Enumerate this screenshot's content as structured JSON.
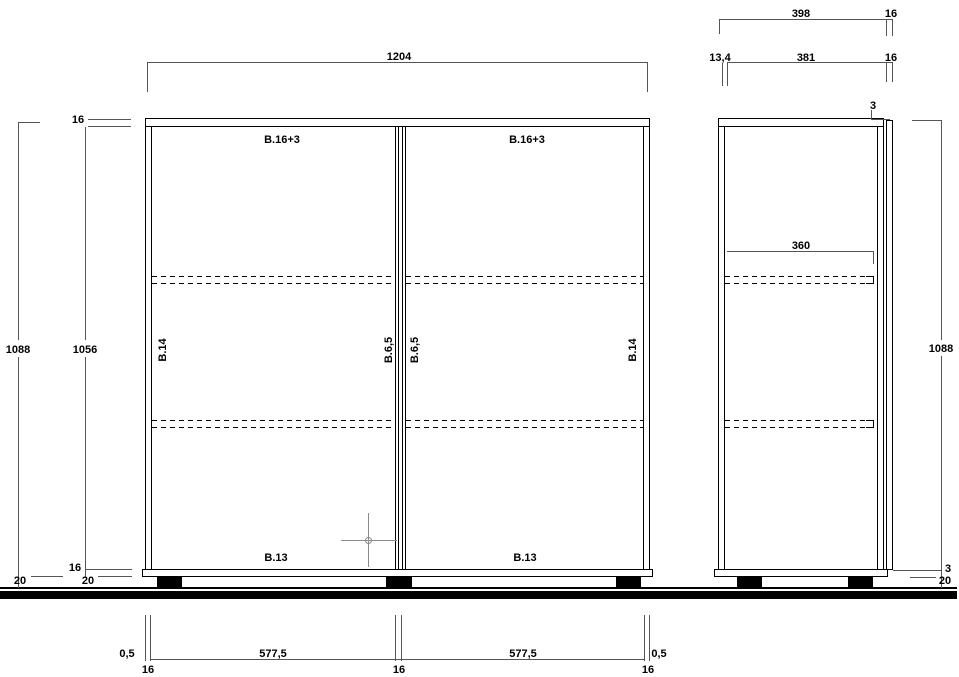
{
  "canvas": {
    "background": "#ffffff"
  },
  "colors": {
    "drawing_line": "#000000",
    "dimension_line": "#555555",
    "crosshair": "#8c8c8c",
    "foot_fill": "#000000",
    "ground_fill": "#000000"
  },
  "front_view": {
    "dim_width": "1204",
    "dim_top_thickness": "16",
    "dim_height_outer": "1088",
    "dim_height_inner": "1056",
    "dim_bottom_thickness": "16",
    "dim_plinth_left": "20",
    "dim_plinth_right": "20",
    "label_top_panel_left": "B.16+3",
    "label_top_panel_right": "B.16+3",
    "label_side_panel_left": "B.14",
    "label_side_panel_right": "B.14",
    "label_divider_left": "B.6,5",
    "label_divider_right": "B.6,5",
    "label_bottom_panel_left": "B.13",
    "label_bottom_panel_right": "B.13",
    "bottom_dims": {
      "offset_left": "0,5",
      "thickness_left": "16",
      "bay_left": "577,5",
      "thickness_center": "16",
      "bay_right": "577,5",
      "thickness_right": "16",
      "offset_right": "0,5"
    }
  },
  "side_view": {
    "dim_depth_outer": "398",
    "dim_front_top": "16",
    "dim_back_inset": "13,4",
    "dim_depth_inner": "381",
    "dim_front": "16",
    "dim_gap_top": "3",
    "dim_shelf_depth": "360",
    "dim_height": "1088",
    "dim_gap_bottom": "3",
    "dim_plinth": "20"
  }
}
